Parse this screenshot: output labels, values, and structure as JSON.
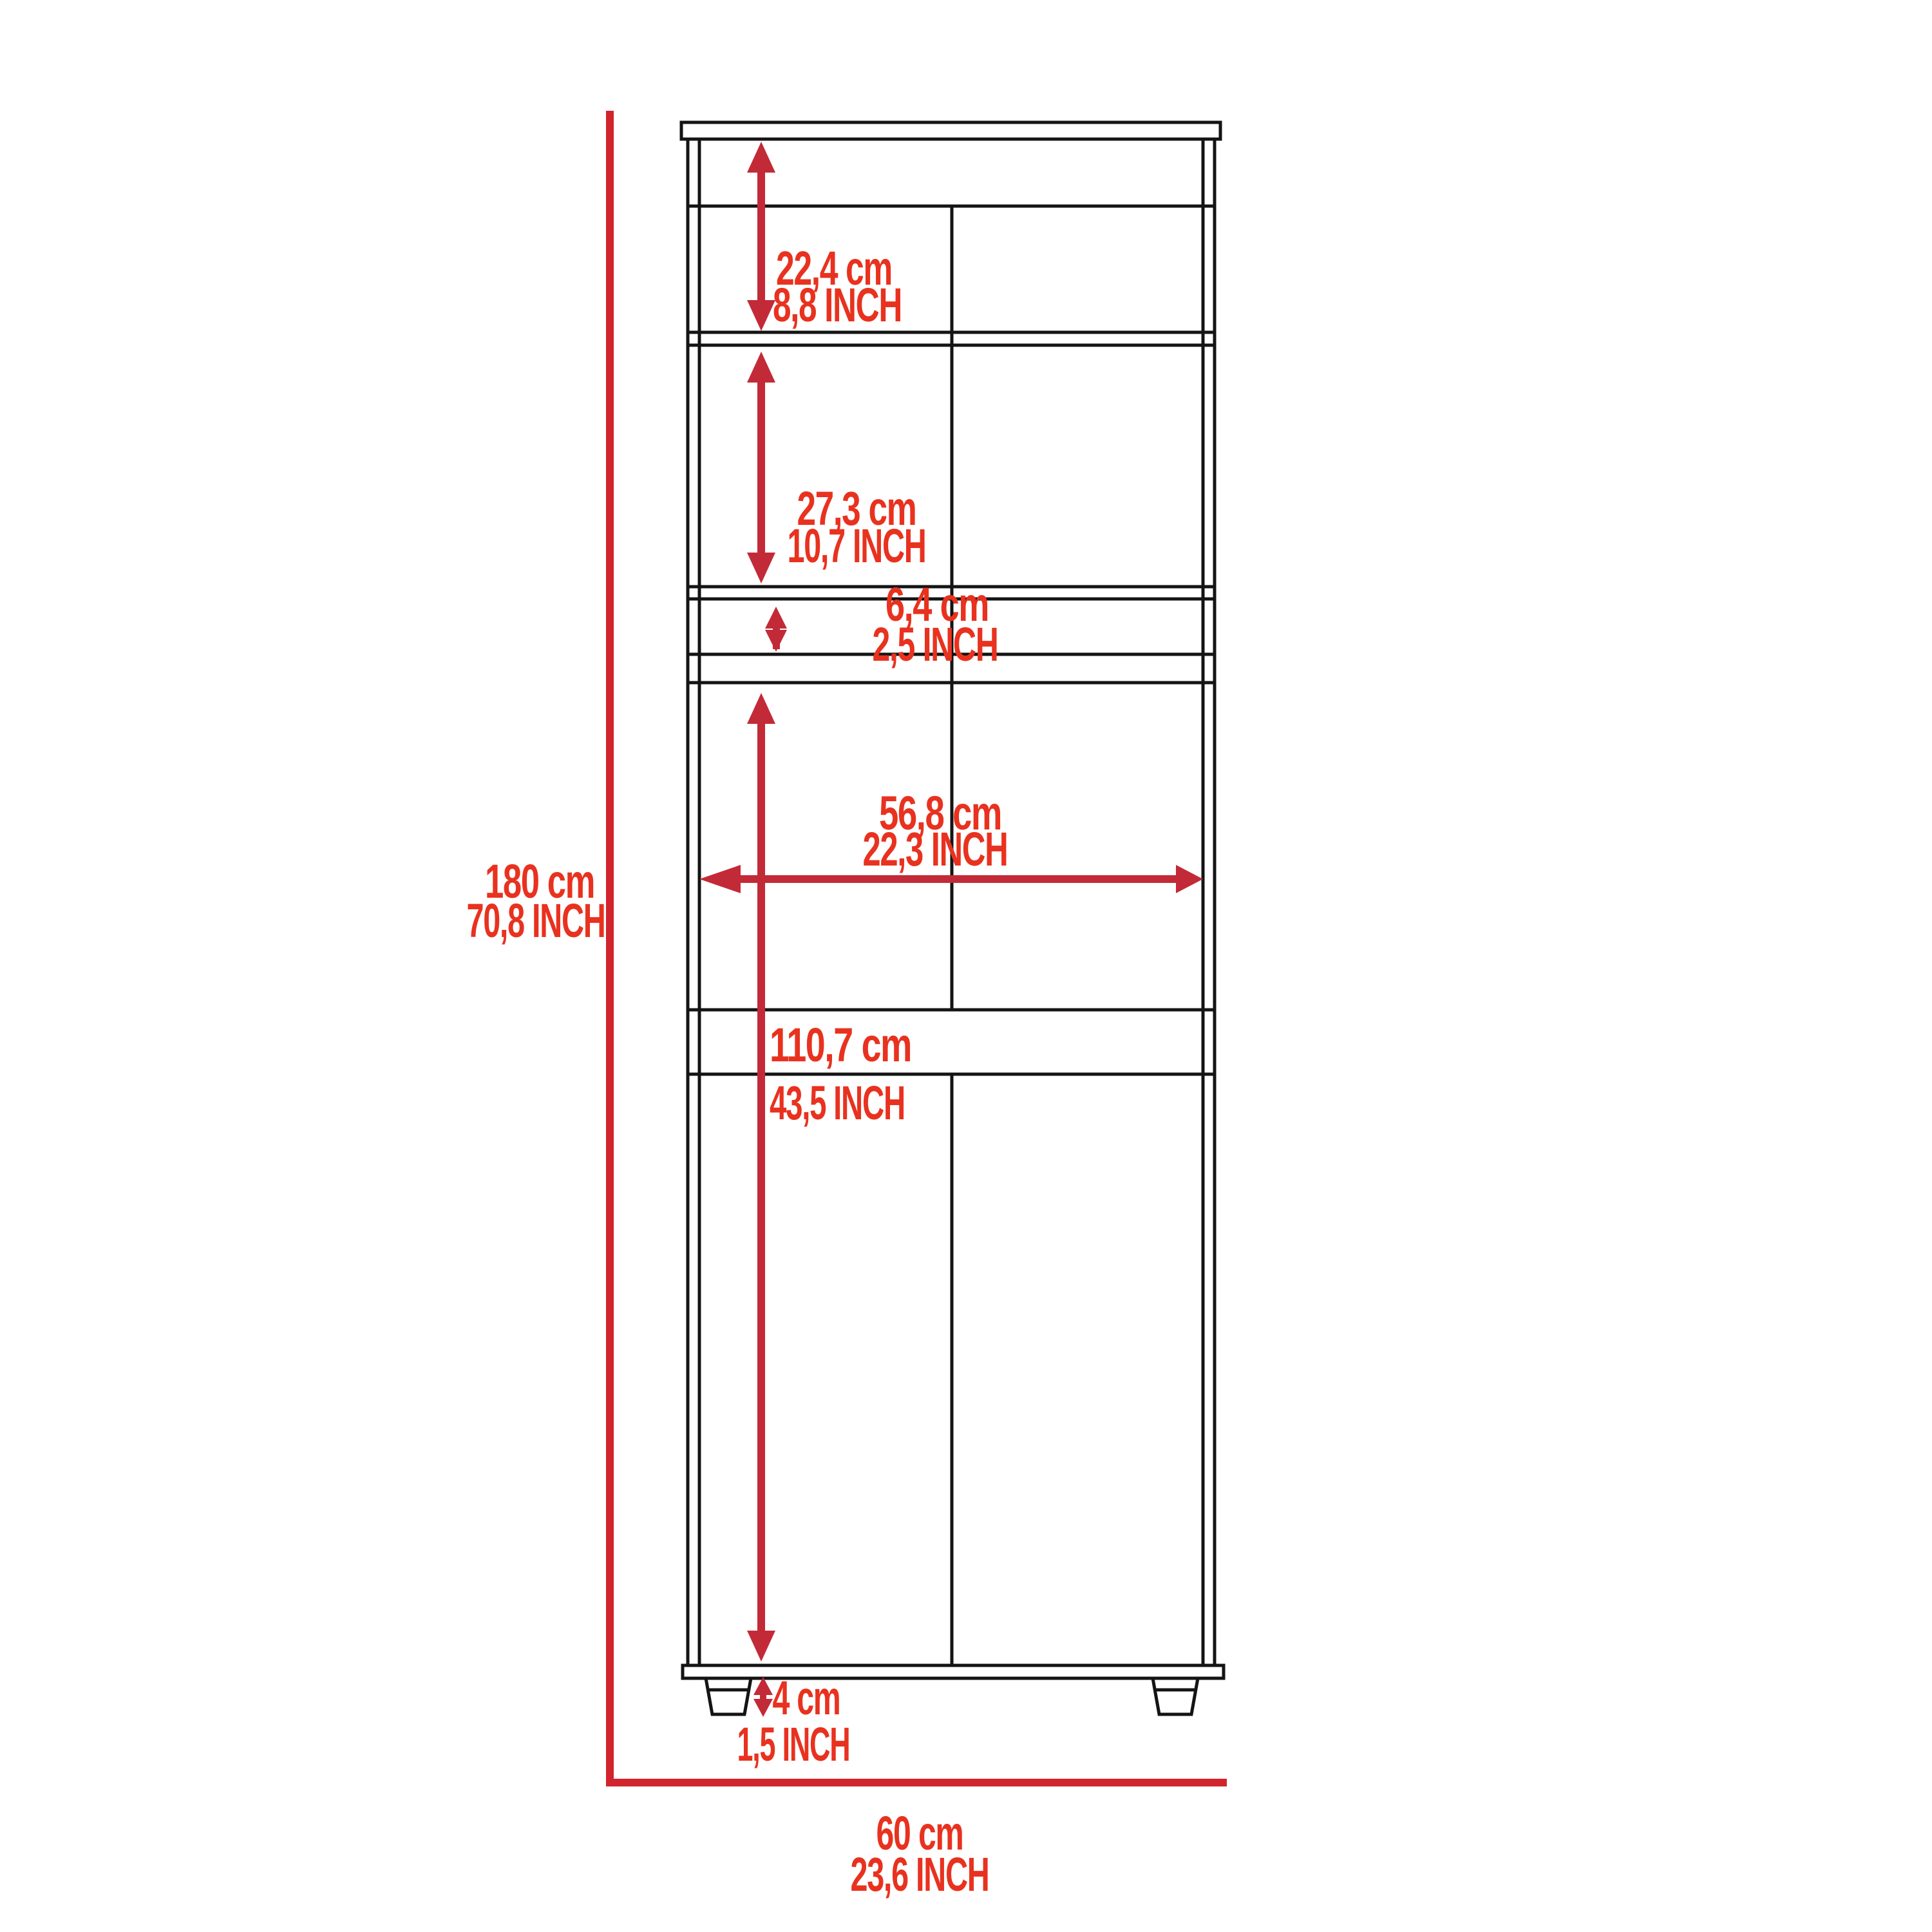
{
  "diagram": {
    "type": "furniture-dimension-drawing",
    "subject": "tall 2-door pantry cabinet with open top compartment, drawers, shelf band and legs",
    "units": [
      "cm",
      "INCH"
    ]
  },
  "colors": {
    "background": "#ffffff",
    "outline": "#141414",
    "label_red": "#e8321f",
    "arrow_red": "#c32a38",
    "rule_red": "#d2242c"
  },
  "dims": {
    "overall_height": {
      "cm": "180 cm",
      "inch": "70,8 INCH"
    },
    "overall_width": {
      "cm": "60 cm",
      "inch": "23,6 INCH"
    },
    "top_compartment": {
      "cm": "22,4 cm",
      "inch": "8,8 INCH"
    },
    "upper_door": {
      "cm": "27,3 cm",
      "inch": "10,7 INCH"
    },
    "open_shelf_gap": {
      "cm": "6,4 cm",
      "inch": "2,5 INCH"
    },
    "interior_width": {
      "cm": "56,8 cm",
      "inch": "22,3 INCH"
    },
    "lower_door": {
      "cm": "110,7 cm",
      "inch": "43,5 INCH"
    },
    "leg_height": {
      "cm": "4 cm",
      "inch": "1,5 INCH"
    }
  }
}
